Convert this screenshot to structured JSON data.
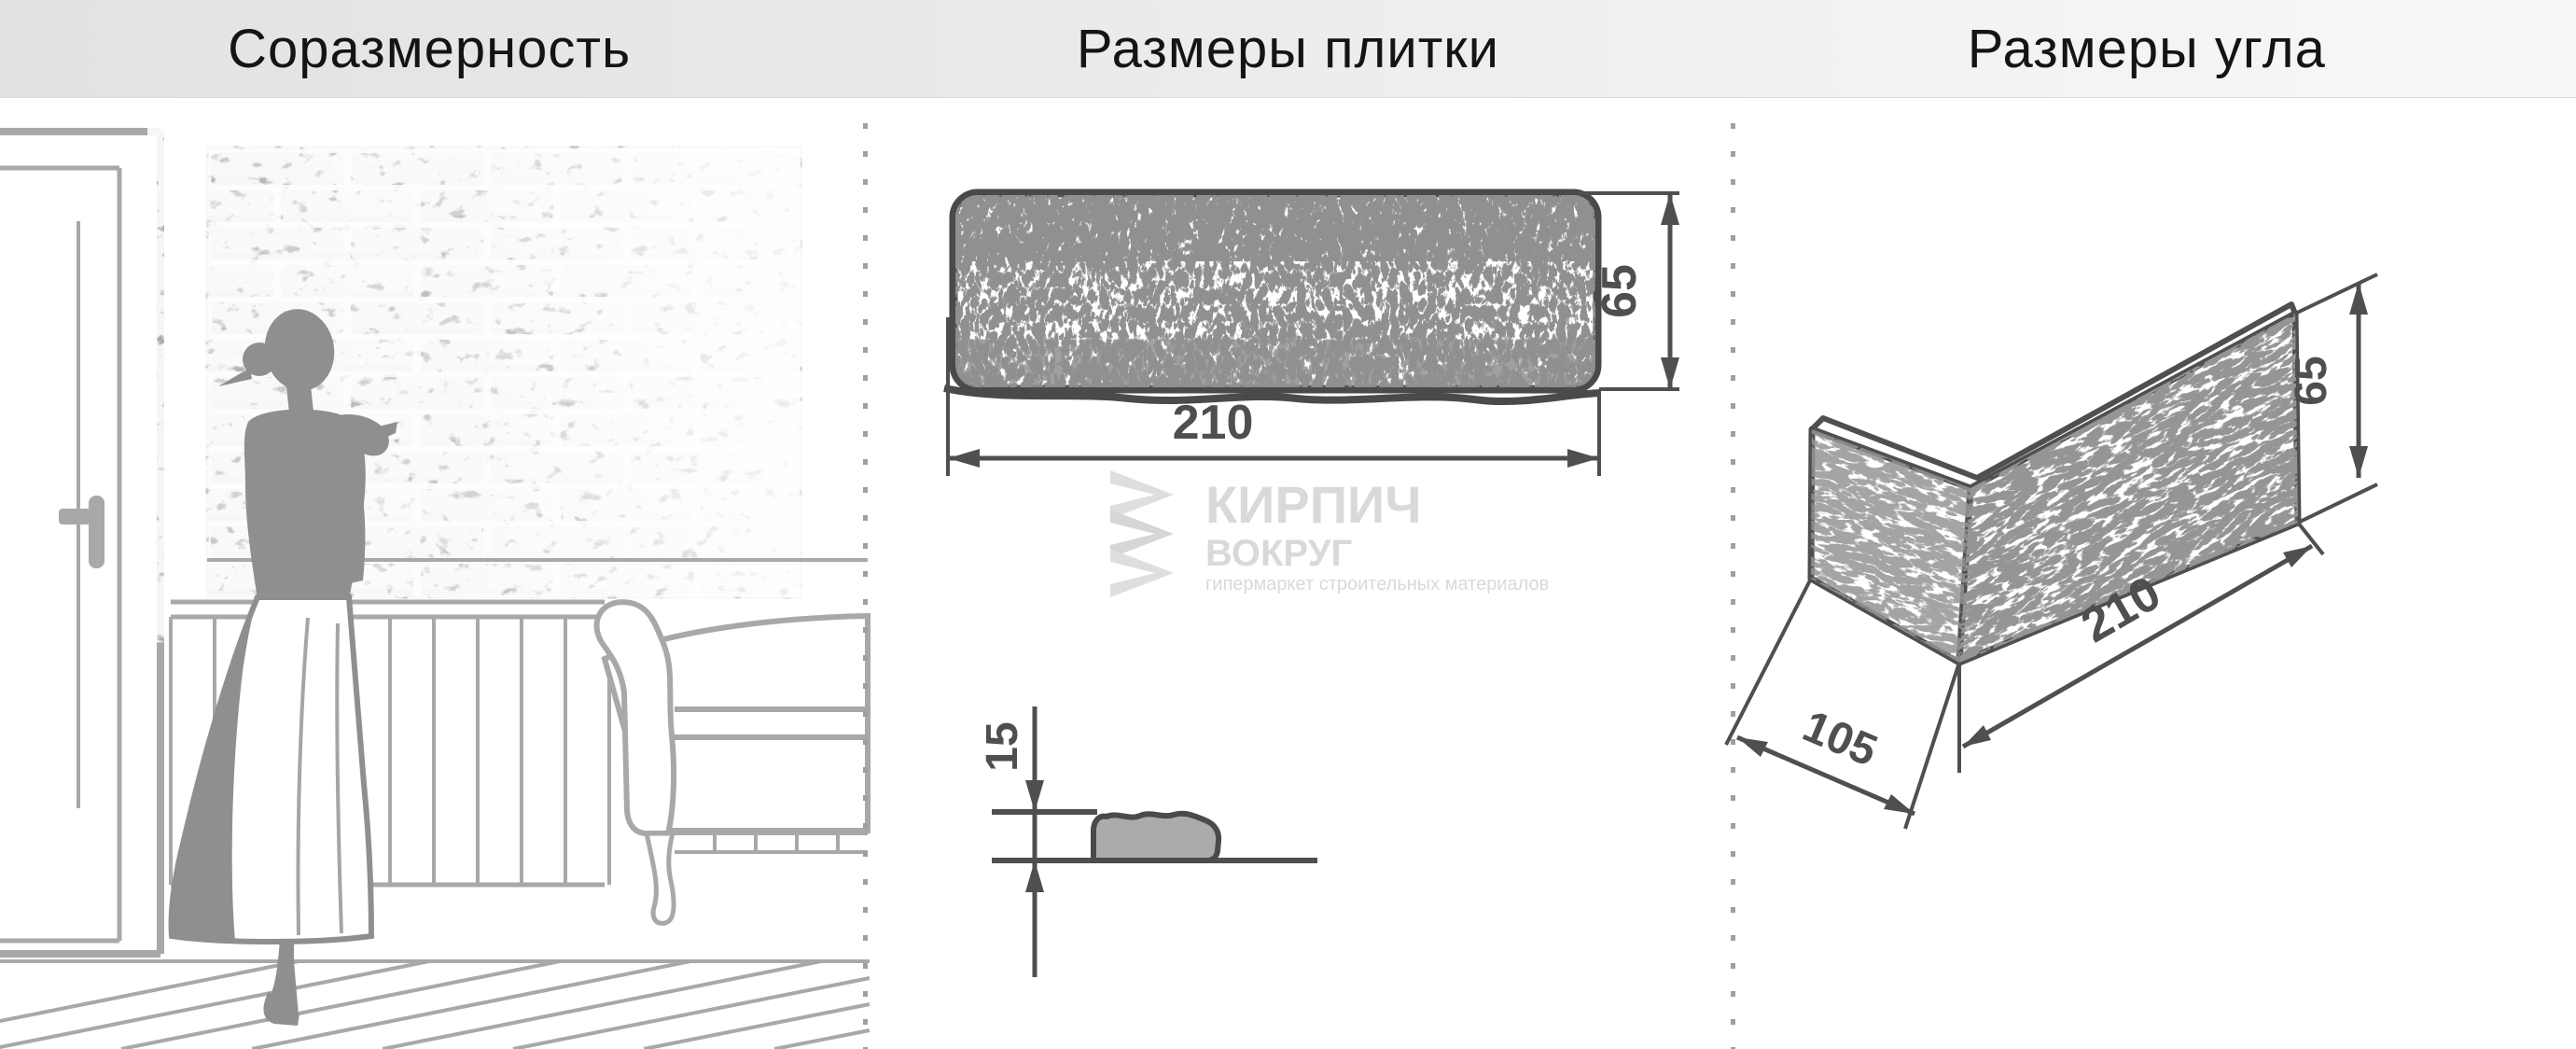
{
  "titles": {
    "left": "Соразмерность",
    "middle": "Размеры плитки",
    "right": "Размеры угла"
  },
  "tile": {
    "width_label": "210",
    "height_label": "65",
    "thickness_label": "15"
  },
  "corner": {
    "length_label": "210",
    "depth_label": "105",
    "height_label": "65"
  },
  "watermark": {
    "brand_line1": "КИРПИЧ",
    "brand_line2": "ВОКРУГ",
    "subtitle": "гипермаркет строительных материалов"
  },
  "colors": {
    "header_background": "#e9e9e9",
    "drawing_lines": "#4f4f4f",
    "scene_lines": "#a8a8a8",
    "silhouette": "#8f8f8f",
    "watermark": "#d9d9d9",
    "divider_dots": "#9f9f9f"
  }
}
